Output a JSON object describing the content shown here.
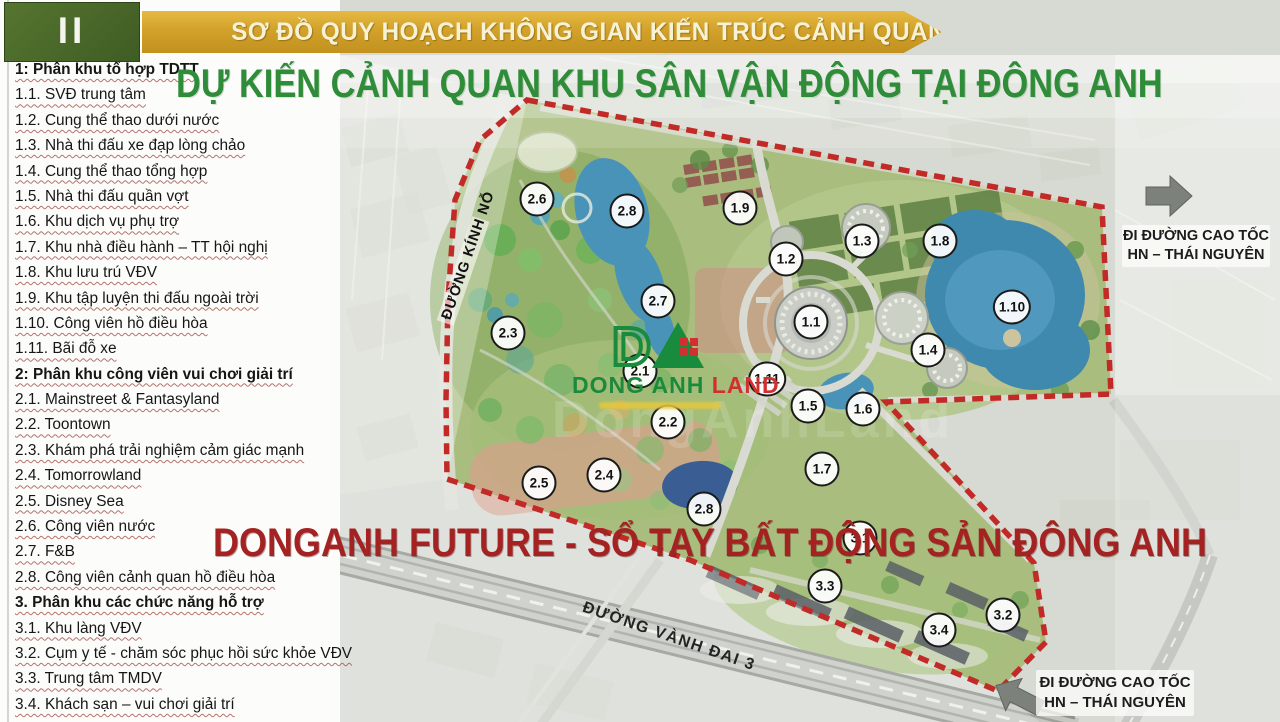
{
  "slide": {
    "section_number": "II",
    "banner_title": "SƠ ĐỒ QUY HOẠCH KHÔNG GIAN KIẾN TRÚC CẢNH QUAN",
    "main_title": "DỰ KIẾN CẢNH QUAN KHU SÂN VẬN ĐỘNG TẠI ĐÔNG ANH",
    "red_banner_text": "DONGANH FUTURE - SỔ TAY BẤT ĐỘNG SẢN ĐÔNG ANH",
    "map_watermark": "DongAnhLand"
  },
  "legend": {
    "items": [
      {
        "text": "1: Phân khu tổ hợp TDTT",
        "bold": true
      },
      {
        "text": "1.1. SVĐ trung tâm",
        "bold": false
      },
      {
        "text": "1.2. Cung thể thao dưới nước",
        "bold": false
      },
      {
        "text": "1.3. Nhà thi đấu xe đạp lòng chảo",
        "bold": false
      },
      {
        "text": "1.4. Cung thể thao tổng hợp",
        "bold": false
      },
      {
        "text": "1.5. Nhà thi đấu quần vợt",
        "bold": false
      },
      {
        "text": "1.6. Khu dịch vụ phụ trợ",
        "bold": false
      },
      {
        "text": "1.7. Khu nhà điều hành – TT hội nghị",
        "bold": false
      },
      {
        "text": "1.8. Khu lưu trú VĐV",
        "bold": false
      },
      {
        "text": "1.9. Khu tập luyện thi đấu ngoài trời",
        "bold": false
      },
      {
        "text": "1.10. Công viên hồ điều hòa",
        "bold": false
      },
      {
        "text": "1.11. Bãi đỗ xe",
        "bold": false
      },
      {
        "text": "2: Phân khu công viên vui chơi giải trí",
        "bold": true
      },
      {
        "text": "2.1. Mainstreet & Fantasyland",
        "bold": false
      },
      {
        "text": "2.2. Toontown",
        "bold": false
      },
      {
        "text": "2.3. Khám phá trải nghiệm cảm giác mạnh",
        "bold": false
      },
      {
        "text": "2.4. Tomorrowland",
        "bold": false
      },
      {
        "text": "2.5. Disney Sea",
        "bold": false
      },
      {
        "text": "2.6. Công viên nước",
        "bold": false
      },
      {
        "text": "2.7. F&B",
        "bold": false
      },
      {
        "text": "2.8. Công viên cảnh quan hồ điều hòa",
        "bold": false
      },
      {
        "text": "3. Phân khu các chức năng hỗ trợ",
        "bold": true
      },
      {
        "text": "3.1. Khu làng VĐV",
        "bold": false
      },
      {
        "text": "3.2. Cụm y tế - chăm sóc phục hồi sức khỏe VĐV",
        "bold": false
      },
      {
        "text": "3.3. Trung tâm TMDV",
        "bold": false
      },
      {
        "text": "3.4. Khách sạn – vui chơi giải trí",
        "bold": false
      }
    ]
  },
  "map": {
    "markers": [
      {
        "label": "2.6",
        "x": 537,
        "y": 199
      },
      {
        "label": "2.8",
        "x": 627,
        "y": 211
      },
      {
        "label": "1.9",
        "x": 740,
        "y": 208
      },
      {
        "label": "1.3",
        "x": 862,
        "y": 241
      },
      {
        "label": "1.8",
        "x": 940,
        "y": 241
      },
      {
        "label": "1.2",
        "x": 786,
        "y": 259
      },
      {
        "label": "2.7",
        "x": 658,
        "y": 301
      },
      {
        "label": "1.10",
        "x": 1012,
        "y": 307
      },
      {
        "label": "2.3",
        "x": 508,
        "y": 333
      },
      {
        "label": "1.1",
        "x": 811,
        "y": 322
      },
      {
        "label": "1.4",
        "x": 928,
        "y": 350
      },
      {
        "label": "2.1",
        "x": 640,
        "y": 371
      },
      {
        "label": "1.11",
        "x": 767,
        "y": 379
      },
      {
        "label": "1.5",
        "x": 808,
        "y": 406
      },
      {
        "label": "1.6",
        "x": 863,
        "y": 409
      },
      {
        "label": "2.2",
        "x": 668,
        "y": 422
      },
      {
        "label": "2.4",
        "x": 604,
        "y": 475
      },
      {
        "label": "1.7",
        "x": 822,
        "y": 469
      },
      {
        "label": "2.5",
        "x": 539,
        "y": 483
      },
      {
        "label": "2.8",
        "x": 704,
        "y": 509
      },
      {
        "label": "3.1",
        "x": 860,
        "y": 538
      },
      {
        "label": "3.3",
        "x": 825,
        "y": 586
      },
      {
        "label": "3.2",
        "x": 1003,
        "y": 615
      },
      {
        "label": "3.4",
        "x": 939,
        "y": 630
      }
    ],
    "road_labels": [
      {
        "text": "ĐƯỜNG KÍNH NỖ"
      },
      {
        "text": "ĐƯỜNG VÀNH ĐAI 3"
      }
    ],
    "highway_note": {
      "line1": "ĐI ĐƯỜNG CAO TỐC",
      "line2": "HN – THÁI NGUYÊN"
    }
  },
  "logo": {
    "monogram": "DA",
    "name_part1": "DONG ANH",
    "name_part2": "LAND"
  },
  "colors": {
    "banner_gold": "#d2a22b",
    "section_green": "#4d6b2f",
    "title_green": "#2f8c38",
    "red_banner": "#a42222",
    "boundary_red": "#c22a28",
    "lake_blue": "#4a93b8",
    "site_green": "#a8bd7e"
  }
}
